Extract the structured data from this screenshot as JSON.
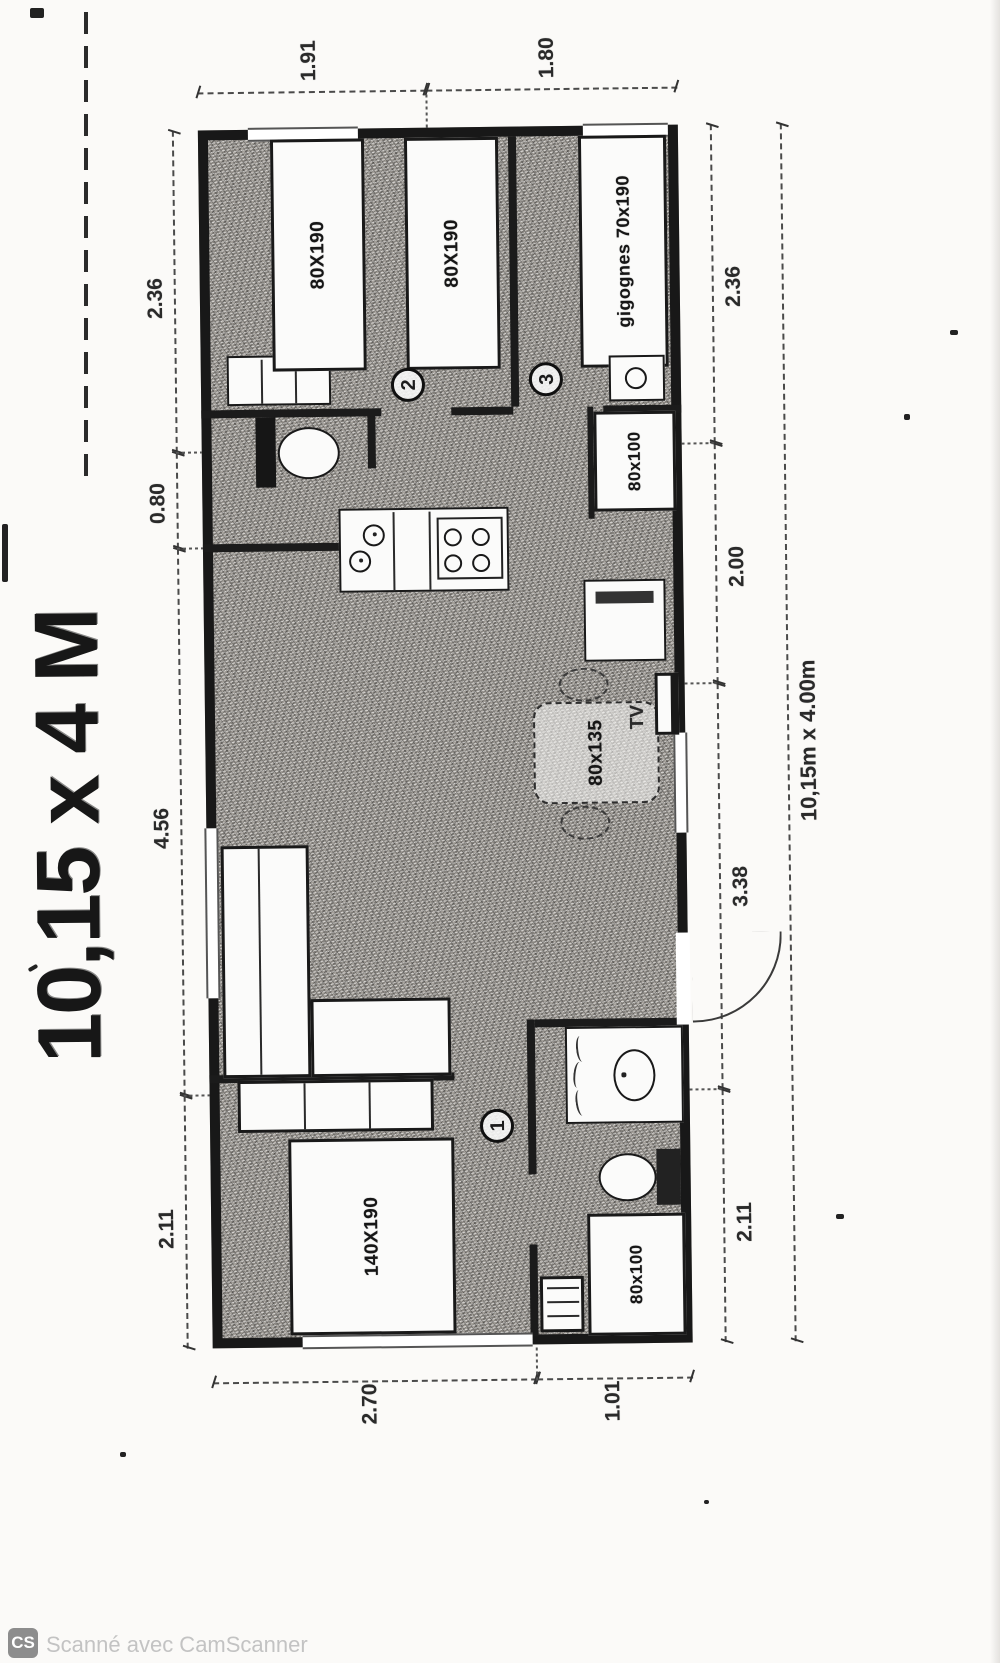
{
  "title": "10,15 x 4 M",
  "watermark": {
    "badge": "CS",
    "text": "Scanné avec CamScanner"
  },
  "plan": {
    "overall": "10,15m x 4.00m",
    "dims_top": [
      "2.11",
      "4.56",
      "0.80",
      "2.36"
    ],
    "dims_right": [
      "1.91",
      "1.80"
    ],
    "dims_bottom": [
      "2.11",
      "3.38",
      "2.00",
      "2.36"
    ],
    "dims_left": [
      "2.70",
      "1.01"
    ],
    "rooms": {
      "bedroom1": {
        "num": "1",
        "bed": "140X190"
      },
      "bedroom2": {
        "num": "2",
        "bed_a": "80X190",
        "bed_b": "80X190"
      },
      "bedroom3": {
        "num": "3",
        "bed": "gigognes 70x190"
      },
      "shower_room": {
        "shower": "80x100"
      },
      "bathroom": {
        "shower": "80x100"
      },
      "living": {
        "tv": "TV",
        "table": "80x135"
      }
    }
  }
}
